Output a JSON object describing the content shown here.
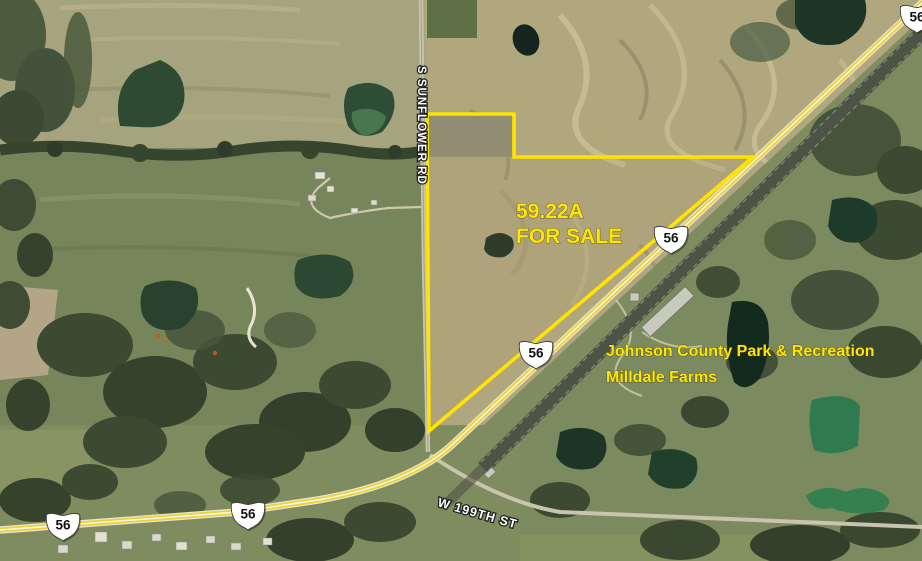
{
  "map": {
    "view_type": "satellite-aerial",
    "parcel": {
      "area": "59.22A",
      "status": "FOR SALE",
      "outline_color": "#FFE600"
    },
    "poi": {
      "line1": "Johnson County Park & Recreation",
      "line2": "Milldale Farms",
      "text_color": "#FFE600"
    },
    "roads": {
      "north_south": "S SUNFLOWER RD",
      "east_west": "W 199TH ST"
    },
    "highway": {
      "shield": "56"
    },
    "colors": {
      "highway_overlay": "#EED23B",
      "railroad_band": "#4E5445",
      "field_tan": "#B1A77F",
      "field_green": "#76855A",
      "trees": "#3A4830",
      "pond_dark": "#1E3526",
      "pond_bright": "#2F7A50",
      "road_gray": "#C9C4AE",
      "shield_fill": "#FFFFFF",
      "shield_text": "#111111"
    }
  }
}
